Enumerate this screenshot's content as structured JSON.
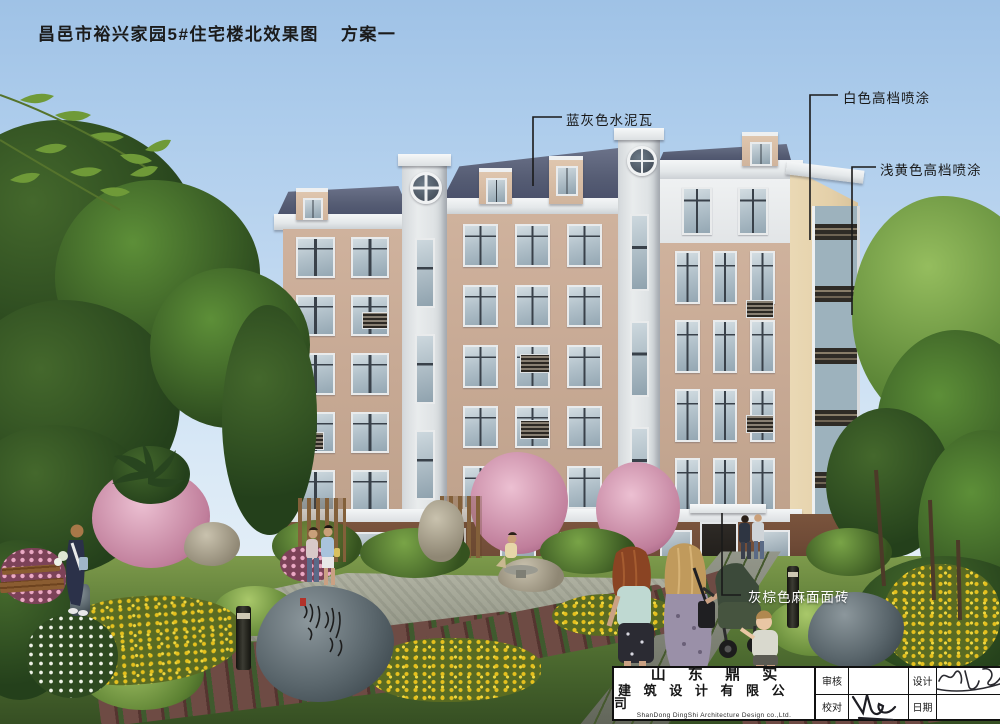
{
  "header": {
    "title": "昌邑市裕兴家园5#住宅楼北效果图",
    "scheme": "方案一"
  },
  "annotations": {
    "roof": {
      "label": "蓝灰色水泥瓦"
    },
    "white": {
      "label": "白色高档喷涂"
    },
    "yellow": {
      "label": "浅黄色高档喷涂"
    },
    "base": {
      "label": "灰棕色麻面面砖"
    }
  },
  "title_block": {
    "company_line1": "山 东 鼎 实",
    "company_line2": "建 筑 设 计 有 限 公 司",
    "company_en": "ShanDong DingShi Architecture Design co.,Ltd.",
    "field_review": "审核",
    "field_design": "设计",
    "field_proof": "校对",
    "field_date": "日期"
  },
  "palette": {
    "sky_top": "#9fc2e6",
    "sky_bottom": "#e3eef7",
    "roof_blue_gray": "#565d74",
    "wall_tan": "#c7a994",
    "trim_white": "#eceff1",
    "gable_light_yellow": "#e8d8b2",
    "base_brown": "#6e4a36",
    "lawn_green": "#4a6a2f",
    "leader_line": "#1a1a1a",
    "label_light": "#ffffff"
  }
}
